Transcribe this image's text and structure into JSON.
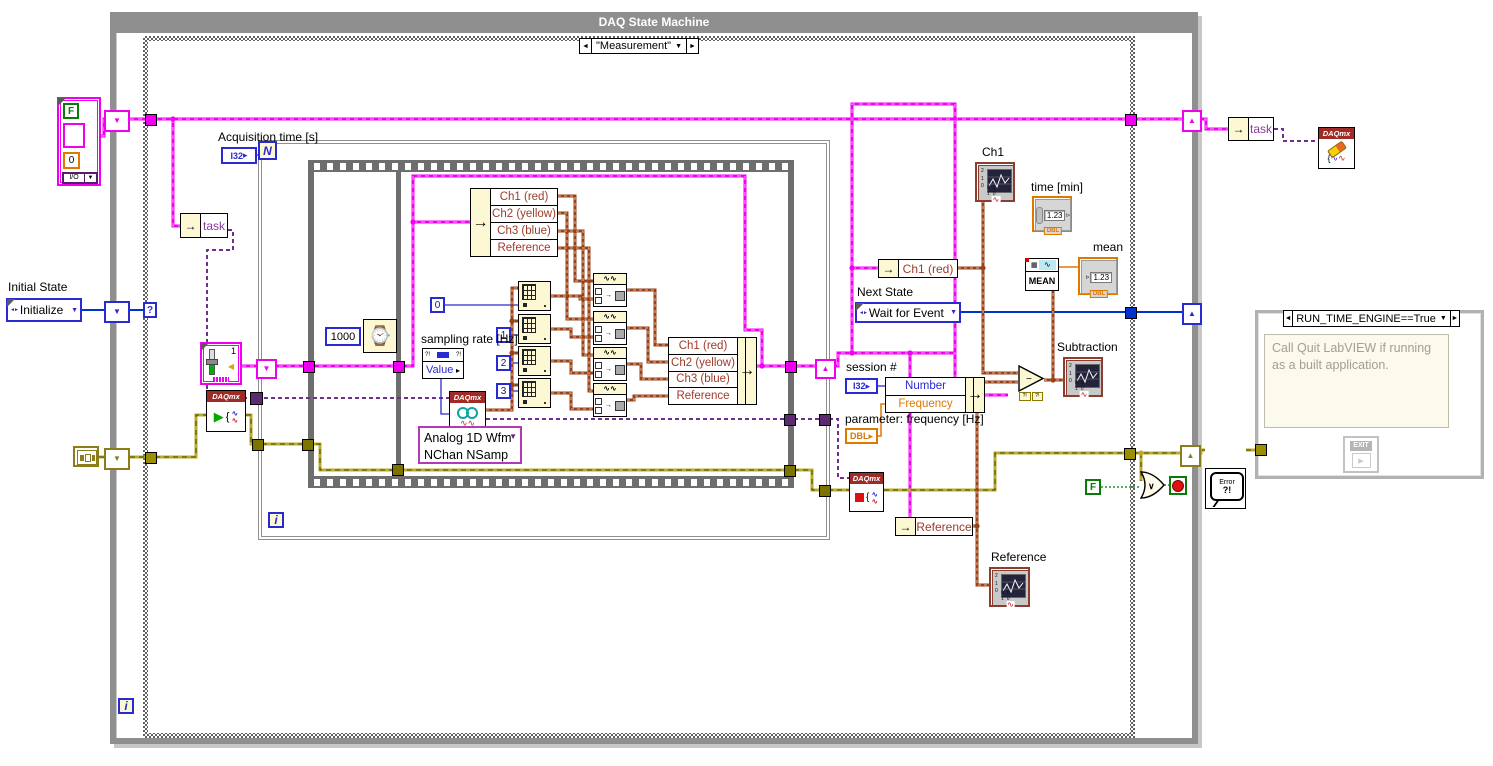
{
  "title": "DAQ State Machine",
  "daqmx_brand": "DAQmx",
  "selectors": {
    "main": "\"Measurement\"",
    "run": "RUN_TIME_ENGINE==True"
  },
  "terminals": {
    "loop_count": "N",
    "iteration": "i",
    "case_selector": "?"
  },
  "types": {
    "i32": "I32",
    "dbl": "DBL"
  },
  "left": {
    "initial_state_label": "Initial State",
    "initial_state_value": "Initialize",
    "cluster": {
      "bool": "F",
      "number": "0",
      "io": "I/O"
    }
  },
  "task_field": "task",
  "for_loop": {
    "label": "Acquisition time [s]",
    "wait_ms": "1000",
    "slider_value": "1"
  },
  "sampling": {
    "label": "sampling rate [Hz]",
    "property": "Value"
  },
  "read_selector": {
    "line1": "Analog 1D Wfm",
    "line2": "NChan NSamp"
  },
  "channels": [
    "Ch1 (red)",
    "Ch2 (yellow)",
    "Ch3 (blue)",
    "Reference"
  ],
  "index_constants": [
    "0",
    "1",
    "2",
    "3"
  ],
  "right": {
    "ch1_chart_label": "Ch1",
    "time_label": "time [min]",
    "mean_label": "mean",
    "mean_fn": "MEAN",
    "indicator_value": "1.23",
    "ch1_red_field": "Ch1 (red)",
    "next_state_label": "Next State",
    "next_state_value": "Wait for Event",
    "session_label": "session #",
    "bundle_fields": {
      "number": "Number",
      "frequency": "Frequency"
    },
    "param_label": "parameter: frequency [Hz]",
    "subtraction_label": "Subtraction",
    "minus": "−",
    "coercion": "?!",
    "reference_field": "Reference",
    "reference_chart_label": "Reference",
    "stop_bool": "F",
    "or_glyph": "∨"
  },
  "outside_right": {
    "task_field": "task",
    "error_handler_line1": "Error",
    "error_handler_line2": "?!",
    "run_comment": "Call Quit LabVIEW if running as a built application.",
    "exit_label": "EXIT"
  },
  "graph_ticks": {
    "y0": "2",
    "y1": "1",
    "y2": "0",
    "x": "00 10"
  },
  "colors": {
    "structure_gray": "#8f8f8f",
    "cluster_wire": "#f000f0",
    "task_wire": "#702f8e",
    "enum_wire": "#0033cc",
    "error_wire": "#b8ab2e",
    "waveform_wire": "#96421c",
    "numeric_blue": "#2a2ad2",
    "dbl_orange": "#e07800",
    "bool_green": "#0a7a0a",
    "daqmx_red": "#9e2b25",
    "field_red": "#9e3a2a"
  }
}
